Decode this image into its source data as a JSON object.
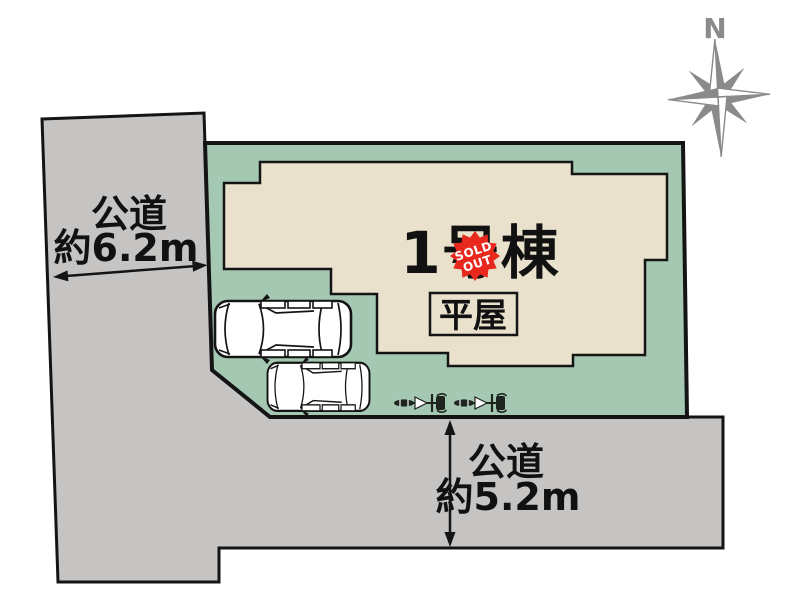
{
  "plan": {
    "building": {
      "name": "1号棟",
      "style_label": "平屋"
    },
    "badge": {
      "line1": "SOLD",
      "line2": "OUT"
    },
    "road_west": {
      "name": "公道",
      "width": "約6.2m"
    },
    "road_south": {
      "name": "公道",
      "width": "約5.2m"
    },
    "compass": {
      "north_label": "N"
    },
    "icons": {
      "compass": "compass-rose-icon",
      "vehicles": [
        "car-icon",
        "car-icon"
      ],
      "bicycles": [
        "bicycle-icon",
        "bicycle-icon"
      ]
    }
  },
  "colors": {
    "lot_green": "#a5c8b2",
    "building_beige": "#e9e1cc",
    "road_gray": "#c5c4c3",
    "line_black": "#141414",
    "text_black": "#111111",
    "sold_red": "#e8271d",
    "compass_gray": "#8a8a8a"
  }
}
